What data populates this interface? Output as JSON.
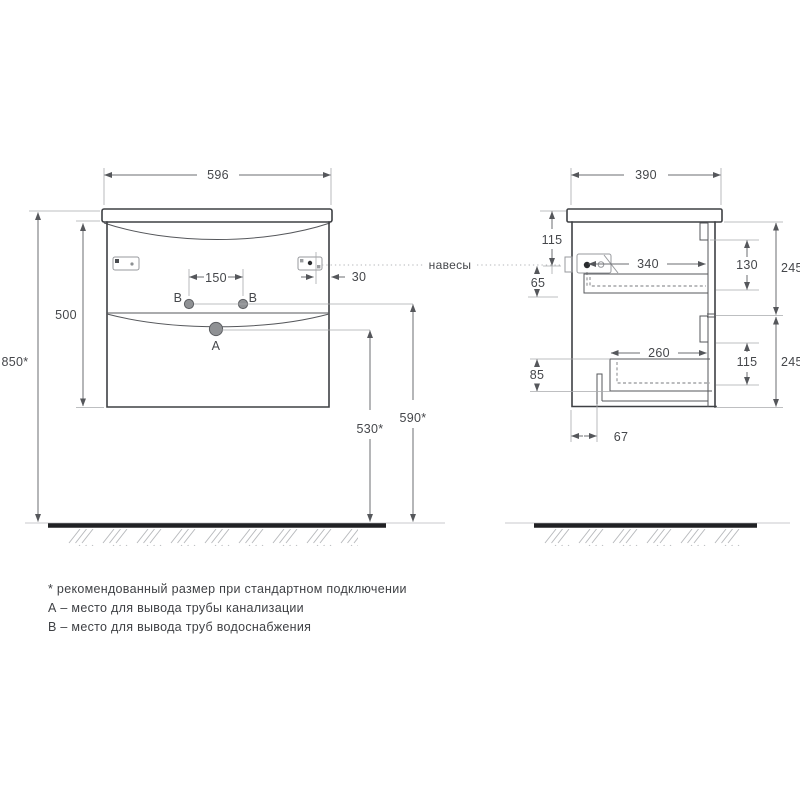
{
  "front_view": {
    "width": "596",
    "body_height": "500",
    "mount_height": "850*",
    "faucet_holes_spacing": "150",
    "hanger_edge_offset": "30",
    "drain_outlet_height": "530*",
    "water_outlet_height": "590*",
    "hole_a_label": "A",
    "hole_b_left_label": "B",
    "hole_b_right_label": "B"
  },
  "side_view": {
    "depth": "390",
    "hanger_top_offset": "115",
    "hanger_drop": "65",
    "upper_drawer_depth": "340",
    "upper_front_inset": "130",
    "upper_drawer_front_height": "245",
    "lower_drawer_depth": "260",
    "bottom_offset": "85",
    "lower_front_inset": "115",
    "lower_drawer_front_height": "245",
    "notch_offset": "67"
  },
  "callout": {
    "hangers_label": "навесы"
  },
  "legend": {
    "note_recommended": "* рекомендованный размер при стандартном подключении",
    "note_a": "А – место для вывода трубы канализации",
    "note_b": "В – место для вывода труб водоснабжения"
  },
  "colors": {
    "outline": "#3e4044",
    "dimension": "#6b6d71",
    "floor": "#202124",
    "hatch": "#b8babd"
  }
}
